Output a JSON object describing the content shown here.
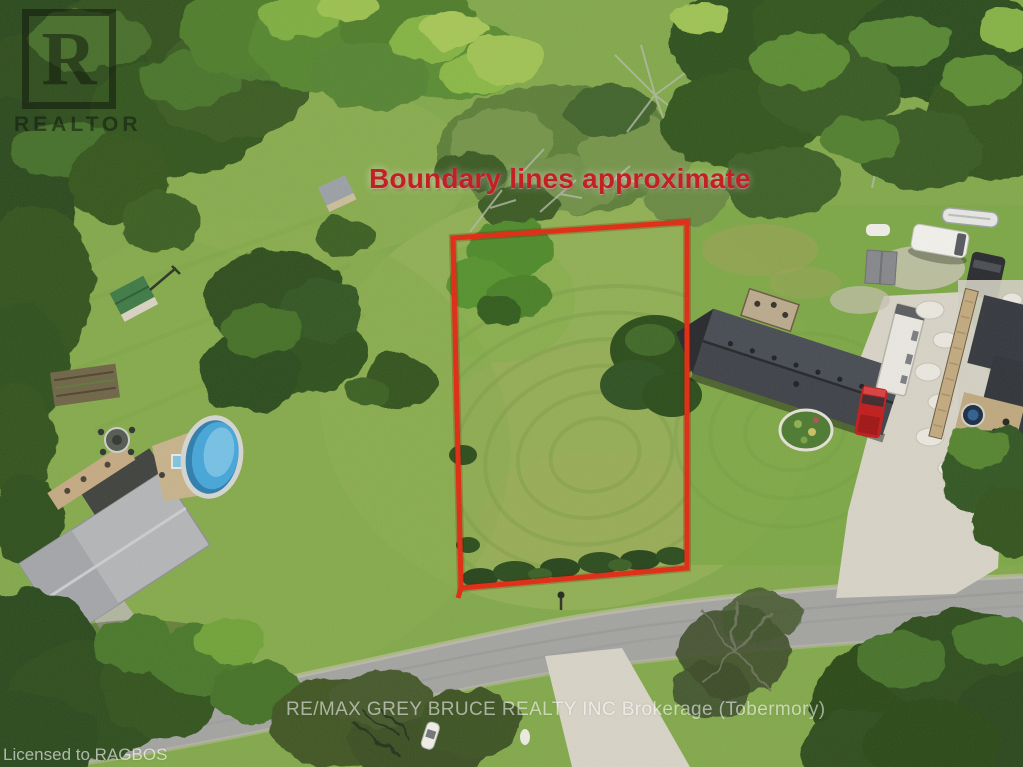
{
  "overlay": {
    "boundary_note": "Boundary lines approximate",
    "brokerage_watermark": "RE/MAX GREY BRUCE REALTY INC Brokerage (Tobermory)",
    "license_watermark": "Licensed to RAGBOS",
    "realtor_logo": {
      "letter": "R",
      "label": "REALTOR"
    }
  },
  "colors": {
    "boundary_red": "#e02a10",
    "note_red": "#c32024",
    "watermark_white": "#ffffff",
    "grass_green": "#82a84a",
    "forest_dark": "#2e4e1d",
    "road_gray": "#a3a3a0",
    "gravel_tan": "#d7d3c6",
    "pool_blue": "#45a6d8",
    "truck_red": "#c01b1b"
  }
}
